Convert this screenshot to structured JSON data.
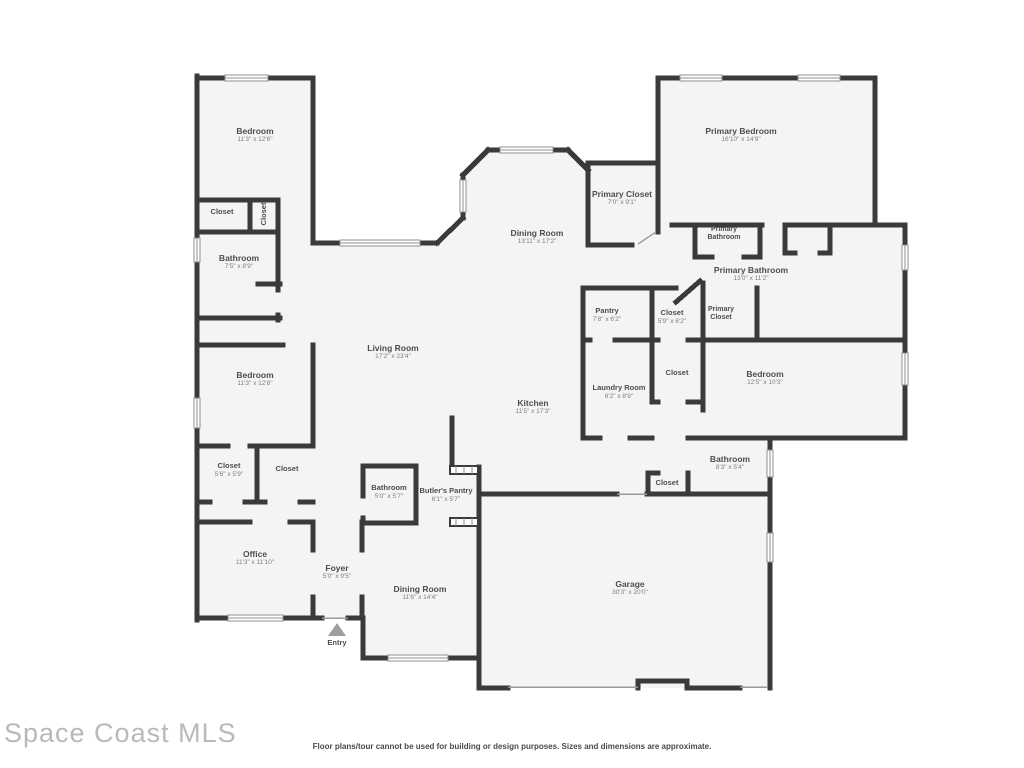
{
  "floor_plan": {
    "colors": {
      "wall": "#3a3a3a",
      "floor": "#f4f4f4",
      "label": "#4d4d4d",
      "dims": "#7e7e7e",
      "door_line": "#9a9a9a"
    },
    "rooms": {
      "bedroom_top_left": {
        "name": "Bedroom",
        "dims": "11'3\" x 12'6\""
      },
      "closet_a": {
        "name": "Closet"
      },
      "closet_b": {
        "name": "Closet"
      },
      "bathroom_top_left": {
        "name": "Bathroom",
        "dims": "7'5\" x 8'9\""
      },
      "bedroom_mid_left": {
        "name": "Bedroom",
        "dims": "11'3\" x 12'8\""
      },
      "closet_1": {
        "name": "Closet",
        "dims": "5'6\" x 5'9\""
      },
      "closet_2": {
        "name": "Closet"
      },
      "office": {
        "name": "Office",
        "dims": "11'3\" x 11'10\""
      },
      "foyer": {
        "name": "Foyer",
        "dims": "5'0\" x 9'5\""
      },
      "entry": {
        "name": "Entry"
      },
      "dining_room_bottom": {
        "name": "Dining Room",
        "dims": "11'6\" x 14'4\""
      },
      "bathroom_small": {
        "name": "Bathroom",
        "dims": "5'0\" x 5'7\""
      },
      "butlers_pantry": {
        "name": "Butler's Pantry",
        "dims": "6'1\" x 5'7\""
      },
      "living_room": {
        "name": "Living Room",
        "dims": "17'2\" x 23'4\""
      },
      "kitchen": {
        "name": "Kitchen",
        "dims": "11'5\" x 17'3\""
      },
      "dining_room_top": {
        "name": "Dining Room",
        "dims": "13'11\" x 17'2\""
      },
      "primary_closet_top": {
        "name": "Primary Closet",
        "dims": "7'0\" x 9'1\""
      },
      "primary_bedroom": {
        "name": "Primary Bedroom",
        "dims": "16'10\" x 14'9\""
      },
      "primary_bathroom_wc": {
        "name": "Primary Bathroom"
      },
      "primary_bathroom": {
        "name": "Primary Bathroom",
        "dims": "13'0\" x 11'2\""
      },
      "primary_closet_small": {
        "name": "Primary Closet"
      },
      "pantry": {
        "name": "Pantry",
        "dims": "7'8\" x 6'2\""
      },
      "closet_59": {
        "name": "Closet",
        "dims": "5'9\" x 6'2\""
      },
      "laundry": {
        "name": "Laundry Room",
        "dims": "6'2\" x 8'9\""
      },
      "closet_hall": {
        "name": "Closet"
      },
      "bedroom_right": {
        "name": "Bedroom",
        "dims": "12'5\" x 10'3\""
      },
      "bathroom_right": {
        "name": "Bathroom",
        "dims": "8'3\" x 5'4\""
      },
      "closet_garage": {
        "name": "Closet"
      },
      "garage": {
        "name": "Garage",
        "dims": "30'3\" x 20'0\""
      }
    }
  },
  "watermark": "Space Coast MLS",
  "disclaimer": "Floor plans/tour cannot be used for building or design purposes. Sizes and dimensions are approximate."
}
